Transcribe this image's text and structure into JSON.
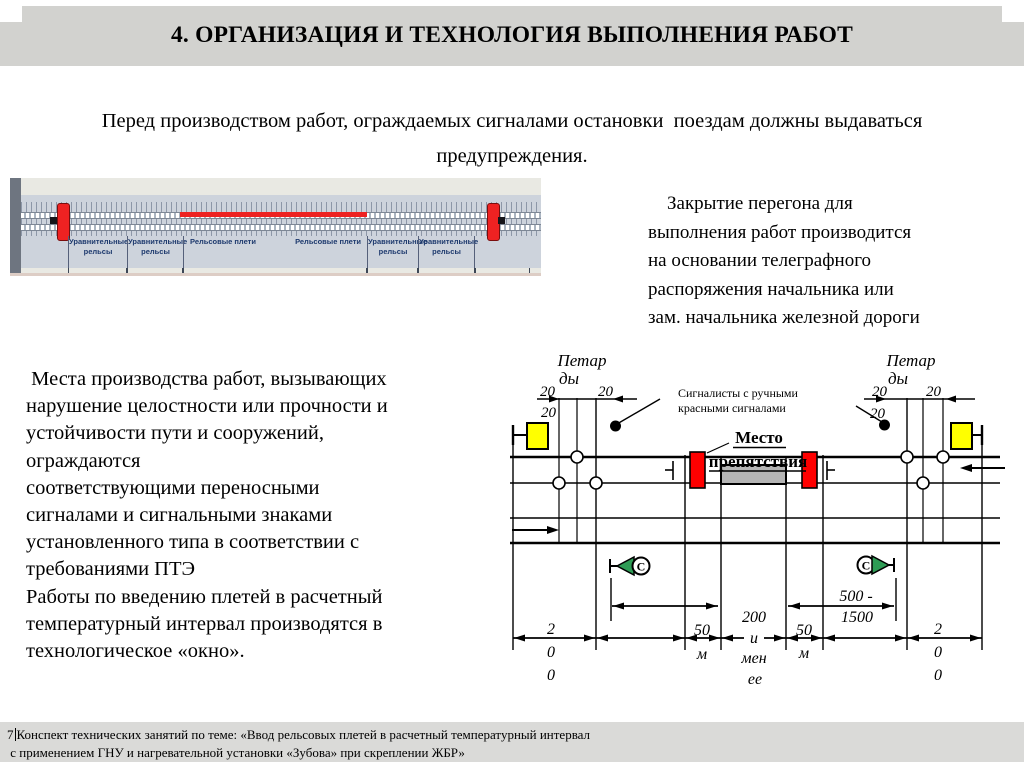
{
  "slide": {
    "title": "4. ОРГАНИЗАЦИЯ И ТЕХНОЛОГИЯ ВЫПОЛНЕНИЯ РАБОТ",
    "intro": "Перед производством работ, ограждаемых сигналами остановки  поездам должны выдаваться\nпредупреждения.",
    "closure_note": "    Закрытие перегона для\nвыполнения работ производится\nна основании телеграфного\nраспоряжения начальника или\nзам. начальника железной дороги",
    "fencing_note": " Места производства работ, вызывающих\nнарушение целостности или прочности и\nустойчивости пути и сооружений,\nограждаются\nсоответствующими переносными\nсигналами и сигнальными знаками\nустановленного типа в соответствии с\nтребованиями ПТЭ\nРаботы по введению плетей в расчетный\nтемпературный интервал производятся в\nтехнологическое «окно»."
  },
  "rail_photo": {
    "section_labels": [
      "Уравнительные рельсы",
      "Уравнительные рельсы",
      "Рельсовые плети",
      "Рельсовые плети",
      "Уравнительные рельсы",
      "Уравнительные рельсы"
    ]
  },
  "scheme": {
    "petards_line1": "Петар",
    "petards_line2": "ды",
    "dist20": "20",
    "signalmen_line1": "Сигналисты с ручными",
    "signalmen_line2": "красными сигналами",
    "obstruction_line1": "Место",
    "obstruction_line2": "препятствия",
    "whistle_letter": "С",
    "dim_500_1500_line1": "500 -",
    "dim_500_1500_line2": "1500",
    "dim_50": "50",
    "meters_unit": "м",
    "dim_200_less_lines": [
      "200",
      "и",
      "мен",
      "ее"
    ],
    "dim_200_chars": [
      "2",
      "0",
      "0"
    ]
  },
  "footer": {
    "page_number": "7",
    "line1": "Конспект технических занятий по теме: «Ввод рельсовых плетей в расчетный температурный интервал",
    "line2": " с применением ГНУ и нагревательной установки «Зубова» при скреплении ЖБР»"
  },
  "colors": {
    "signal_yellow": "#ffff00",
    "signal_red": "#ff0000",
    "whistle_green": "#2e9c55",
    "obstruction_gray": "#b5b5b5",
    "photo_heated_red": "#ee2222",
    "title_band_gray": "#d2d2cf"
  }
}
